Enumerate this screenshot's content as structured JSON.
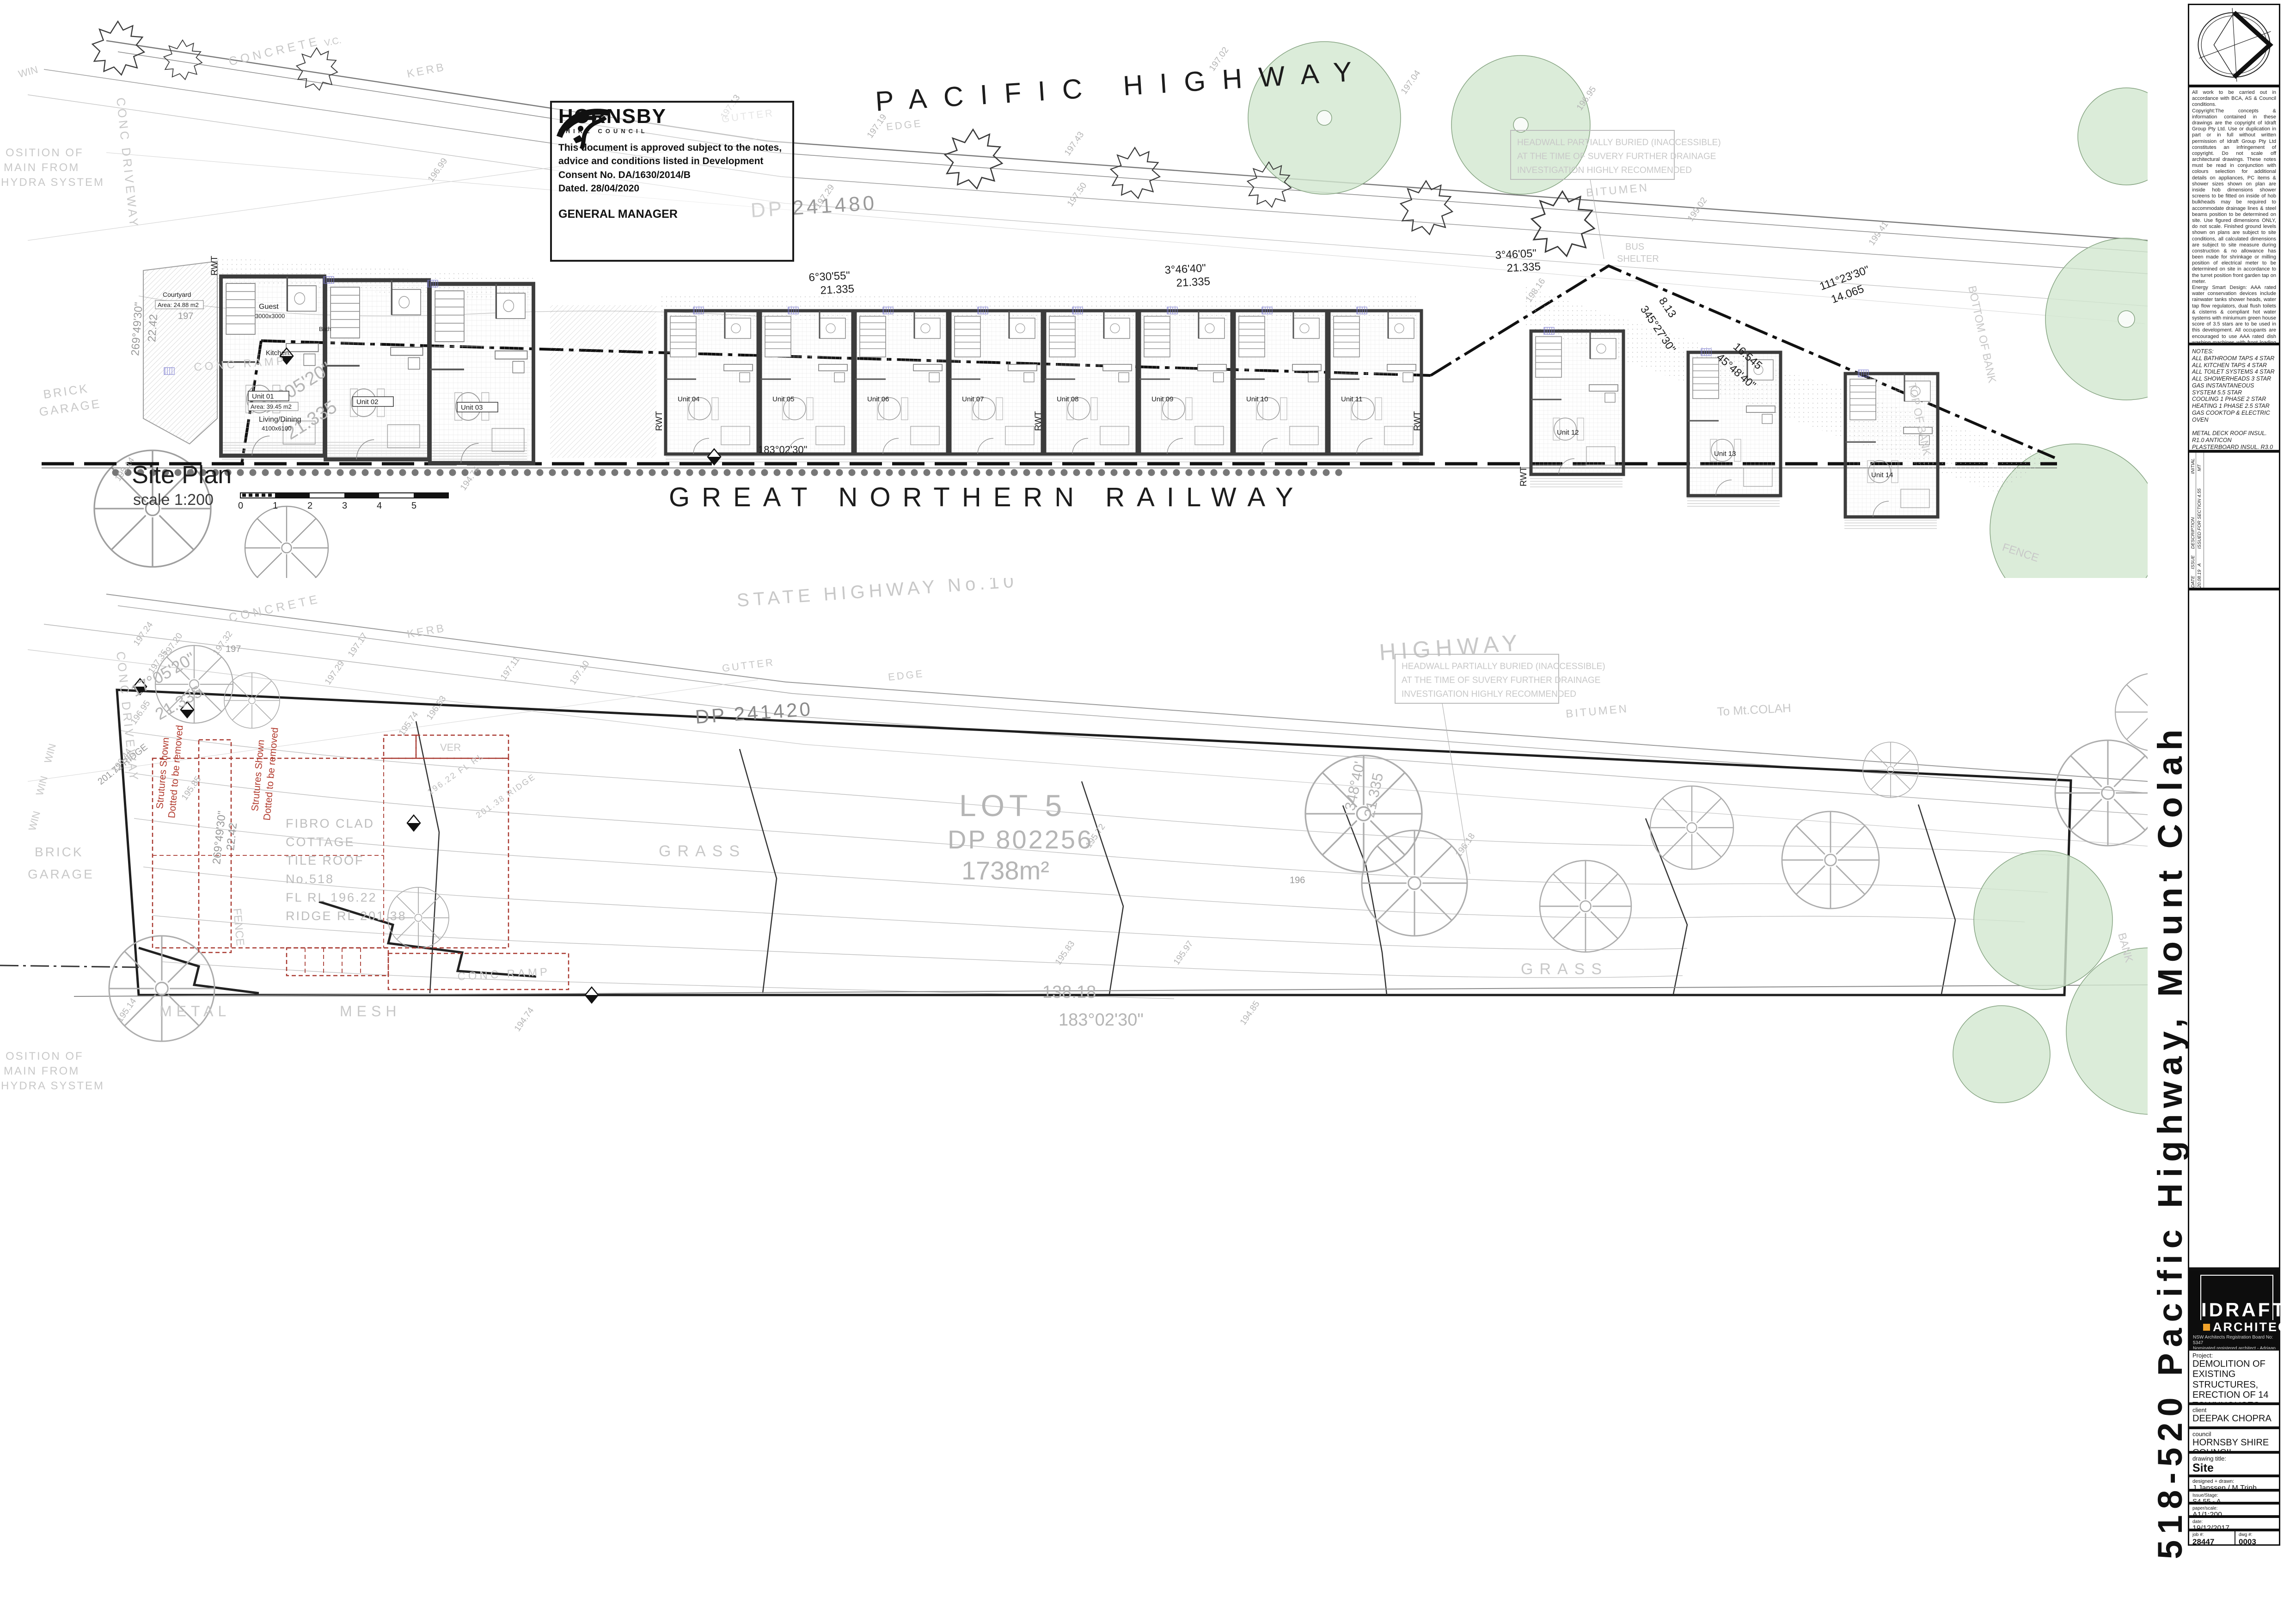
{
  "stamp": {
    "org": "HORNSBY",
    "org_sub": "SHIRE COUNCIL",
    "l1": "This document is approved subject to the notes,",
    "l2": "advice and conditions listed in Development",
    "l3": "Consent No. DA/1630/2014/B",
    "l4": "Dated. 28/04/2020",
    "sign": "GENERAL MANAGER"
  },
  "top": {
    "highway": "PACIFIC HIGHWAY",
    "railway": "GREAT NORTHERN RAILWAY",
    "plan_name": "Site Plan",
    "plan_scale": "scale 1:200",
    "dp": "DP 241480",
    "hw1": "HEADWALL PARTIALLY BURIED (INACCESSIBLE)",
    "hw2": "AT THE TIME OF SUVERY FURTHER DRAINAGE",
    "hw3": "INVESTIGATION HIGHLY RECOMMENDED",
    "concrete": "CONCRETE",
    "kerb": "KERB",
    "gutter": "GUTTER",
    "edge": "EDGE",
    "vc": "V.C.",
    "bitumen": "BITUMEN",
    "bus1": "BUS",
    "bus2": "SHELTER",
    "bottom_bank": "BOTTOM OF BANK",
    "top_bank": "TOP OF BANK",
    "fence": "FENCE",
    "contour": "197",
    "pos1": "OSITION OF",
    "pos2": "MAIN FROM",
    "pos3": "HYDRA SYSTEM",
    "brick": "BRICK",
    "garage": "GARAGE",
    "win": "WIN",
    "conc_drive": "CONC  DRIVEWAY",
    "conc_ramp": "CONC RAMP",
    "b17a": "17°05'20\"",
    "b17b": "21.335",
    "b6a": "6°30'55\"",
    "b6b": "21.335",
    "b3a": "3°46'40\"",
    "b3b": "21.335",
    "b4a": "3°46'05\"",
    "b4b": "21.335",
    "b111a": "111°23'30\"",
    "b111b": "14.065",
    "b345a": "345°27'30\"",
    "b345b": "8.13",
    "b45a": "45°48'40\"",
    "b45b": "16.545",
    "b183": "183°02'30\"",
    "b269a": "269°49'30\"",
    "b269b": "22.42",
    "secmark": "B-B",
    "levels": [
      "197.13",
      "197.19",
      "197.43",
      "197.50",
      "197.29",
      "196.99",
      "197.02",
      "197.04",
      "196.95",
      "199.02",
      "199.41",
      "198.16",
      "195.14",
      "194.74"
    ],
    "ticks": [
      "0",
      "1",
      "2",
      "3",
      "4",
      "5"
    ],
    "units": [
      "Unit 01",
      "Unit 02",
      "Unit 03",
      "Unit 04",
      "Unit 05",
      "Unit 06",
      "Unit 07",
      "Unit 08",
      "Unit 09",
      "Unit 10",
      "Unit 11",
      "Unit 12",
      "Unit 13",
      "Unit 14"
    ],
    "unit_area": "Area: 39.45 m2",
    "rooms": {
      "guest": "Guest",
      "guest_dim": "3000x3000",
      "kitchen": "Kitchen.",
      "bath": "Bath",
      "living": "Living/Dining",
      "living_dim": "4100x6100",
      "courtyard": "Courtyard",
      "courtyard_area": "Area: 24.88 m2",
      "rwt": "RWT"
    }
  },
  "bottom": {
    "state_hwy": "STATE  HIGHWAY  No.10",
    "highway": "HIGHWAY",
    "to_colah": "To  Mt.COLAH",
    "dp": "DP 241420",
    "hw1": "HEADWALL PARTIALLY BURIED (INACCESSIBLE)",
    "hw2": "AT THE TIME OF SUVERY FURTHER DRAINAGE",
    "hw3": "INVESTIGATION HIGHLY RECOMMENDED",
    "concrete": "CONCRETE",
    "kerb": "KERB",
    "gutter": "GUTTER",
    "edge": "EDGE",
    "bitumen": "BITUMEN",
    "lot": "LOT  5",
    "lot_dp": "DP  802256",
    "lot_area": "1738m²",
    "grass": "GRASS",
    "c1": "FIBRO  CLAD",
    "c2": "COTTAGE",
    "c3": "TILE  ROOF",
    "c4": "No.518",
    "c5": "FL  RL  196.22",
    "c6": "RIDGE  RL  201.38",
    "r1": "Strutures Shown",
    "r2": "Dotted to be removed",
    "ver": "VER",
    "flrl": "196.22 FL RL",
    "ridge": "201.38 RIDGE",
    "ridge_l": "201.72 RIDGE",
    "metal": "METAL",
    "mesh": "MESH",
    "fence": "FENCE",
    "bank": "BANK",
    "b138": "138.18",
    "b183": "183°02'30\"",
    "b348a": "348°40'",
    "b348b": "21.335",
    "b17a": "17°05'20\"",
    "b17b": "21.335",
    "b269a": "269°49'30\"",
    "b269b": "22.42",
    "pos1": "OSITION OF",
    "pos2": "MAIN FROM",
    "pos3": "HYDRA SYSTEM",
    "brick": "BRICK",
    "garage": "GARAGE",
    "win": "WIN",
    "conc_drive": "CONC  DRIVEWAY",
    "conc_ramp": "CONC RAMP",
    "contour": "197",
    "contour2": "196",
    "levels": [
      "197.32",
      "197.24",
      "197.20",
      "197.35",
      "197.29",
      "197.17",
      "197.11",
      "197.10",
      "196.95",
      "196.53",
      "196.44",
      "195.85",
      "195.74",
      "195.72",
      "196.18",
      "195.83",
      "195.97",
      "195.14",
      "194.74",
      "194.85"
    ]
  },
  "sidebar": {
    "notes_general": "All work to be carried out in accordance with BCA, AS & Council conditions.\nCopyright:The concepts & information contained in these drawings are the copyright of Idraft Group Pty Ltd. Use or duplication in part or in full without written permission of Idraft Group Pty Ltd constitutes an infringement of copyright. Do not scale off architectural drawings. These notes must be read in conjunction with colours selection for additional details on appliances, PC items & shower sizes shown on plan are inside hob dimensions shower screens to be fitted on inside of hob bulkheads may be required to accommodate drainage lines & steel beams position to be determined on site. Use figured dimensions ONLY, do not scale. Finished ground levels shown on plans are subject to site conditions, all calculated dimensions are subject to site measure during construction & no allowance has been made for shrinkage or milling position of electrical meter to be determined on site in accordance to the turret position front garden tap on meter.\nEnergy Smart Design: AAA rated water conservation devices include rainwater tanks shower heads, water tap flow regulators, dual flush toilets & cisterns & compliant hot water systems with miniumum green house score of 3.5 stars are to be used in this development. All occupants are encouraged to use AAA rated dish washing machines with front loading where possible.",
    "notes_ratings": "NOTES:\nALL BATHROOM TAPS 4 STAR\nALL KITCHEN TAPS 4 STAR\nALL TOILET SYSTEMS 4 STAR\nALL SHOWERHEADS 3 STAR\nGAS INSTANTANEOUS SYSTEM 5.5 STAR\nCOOLING 1 PHASE 2 STAR\nHEATING 1 PHASE 2.5 STAR\nGAS COOKTOP & ELECTRIC OVEN\n\nMETAL DECK ROOF INSUL. R1.0 ANTICON\nPLASTERBOARD INSUL. R3.0 BULK (ROOF)\nCONC. INSUL. R1.0 EPS (OVER BASEMENT)\nPLASTERBOARD R2.0 BULK (WALLS)\nBRICK VENNER INSUL. R2.0 BULK\nFC CLADDING INSUL. R2.0 BULK",
    "rev": {
      "initial_h": "INITIAL",
      "initial": "MT",
      "date_h": "DATE",
      "date": "20.08.19",
      "issue_h": "ISSUE",
      "issue": "A",
      "desc_h": "DESCRIPTION",
      "desc": "ISSUED FOR SECTION 4.55"
    },
    "firm": {
      "name": "IDRAFT",
      "name2": "ARCHITECTS",
      "reg": "NSW Architects Registration Board No: 5347\nNominated registered architect - Adriaan Winton\np: 02 9648 8848 w: www.idraft.com.au\nm: PO Box 427, Merrylands NSW 2160"
    },
    "project_label": "Project:",
    "project": "DEMOLITION OF EXISTING STRUCTURES, ERECTION OF 14 TOWNHOUSES OVER BASEMENT PARKING.",
    "client_label": "client",
    "client": "DEEPAK CHOPRA",
    "council_label": "council",
    "council": "HORNSBY SHIRE COUNCIL",
    "title_label": "drawing title:",
    "title": "Site Plan/Demolition Plan",
    "designed_label": "designed + drawn:",
    "designed": "J.Janssen / M.Trinh",
    "issue_label": "Issue/Stage:",
    "issue": "S4.55 - A",
    "scale_label": "paper/scale:",
    "scale": "A1/1:200",
    "date_label": "date:",
    "date": "19/12/2017",
    "job_label": "job #:",
    "job": "28447",
    "dwg_label": "dwg #:",
    "dwg": "0003",
    "address_vertical": "518-520 Pacific Highway, Mount Colah"
  }
}
